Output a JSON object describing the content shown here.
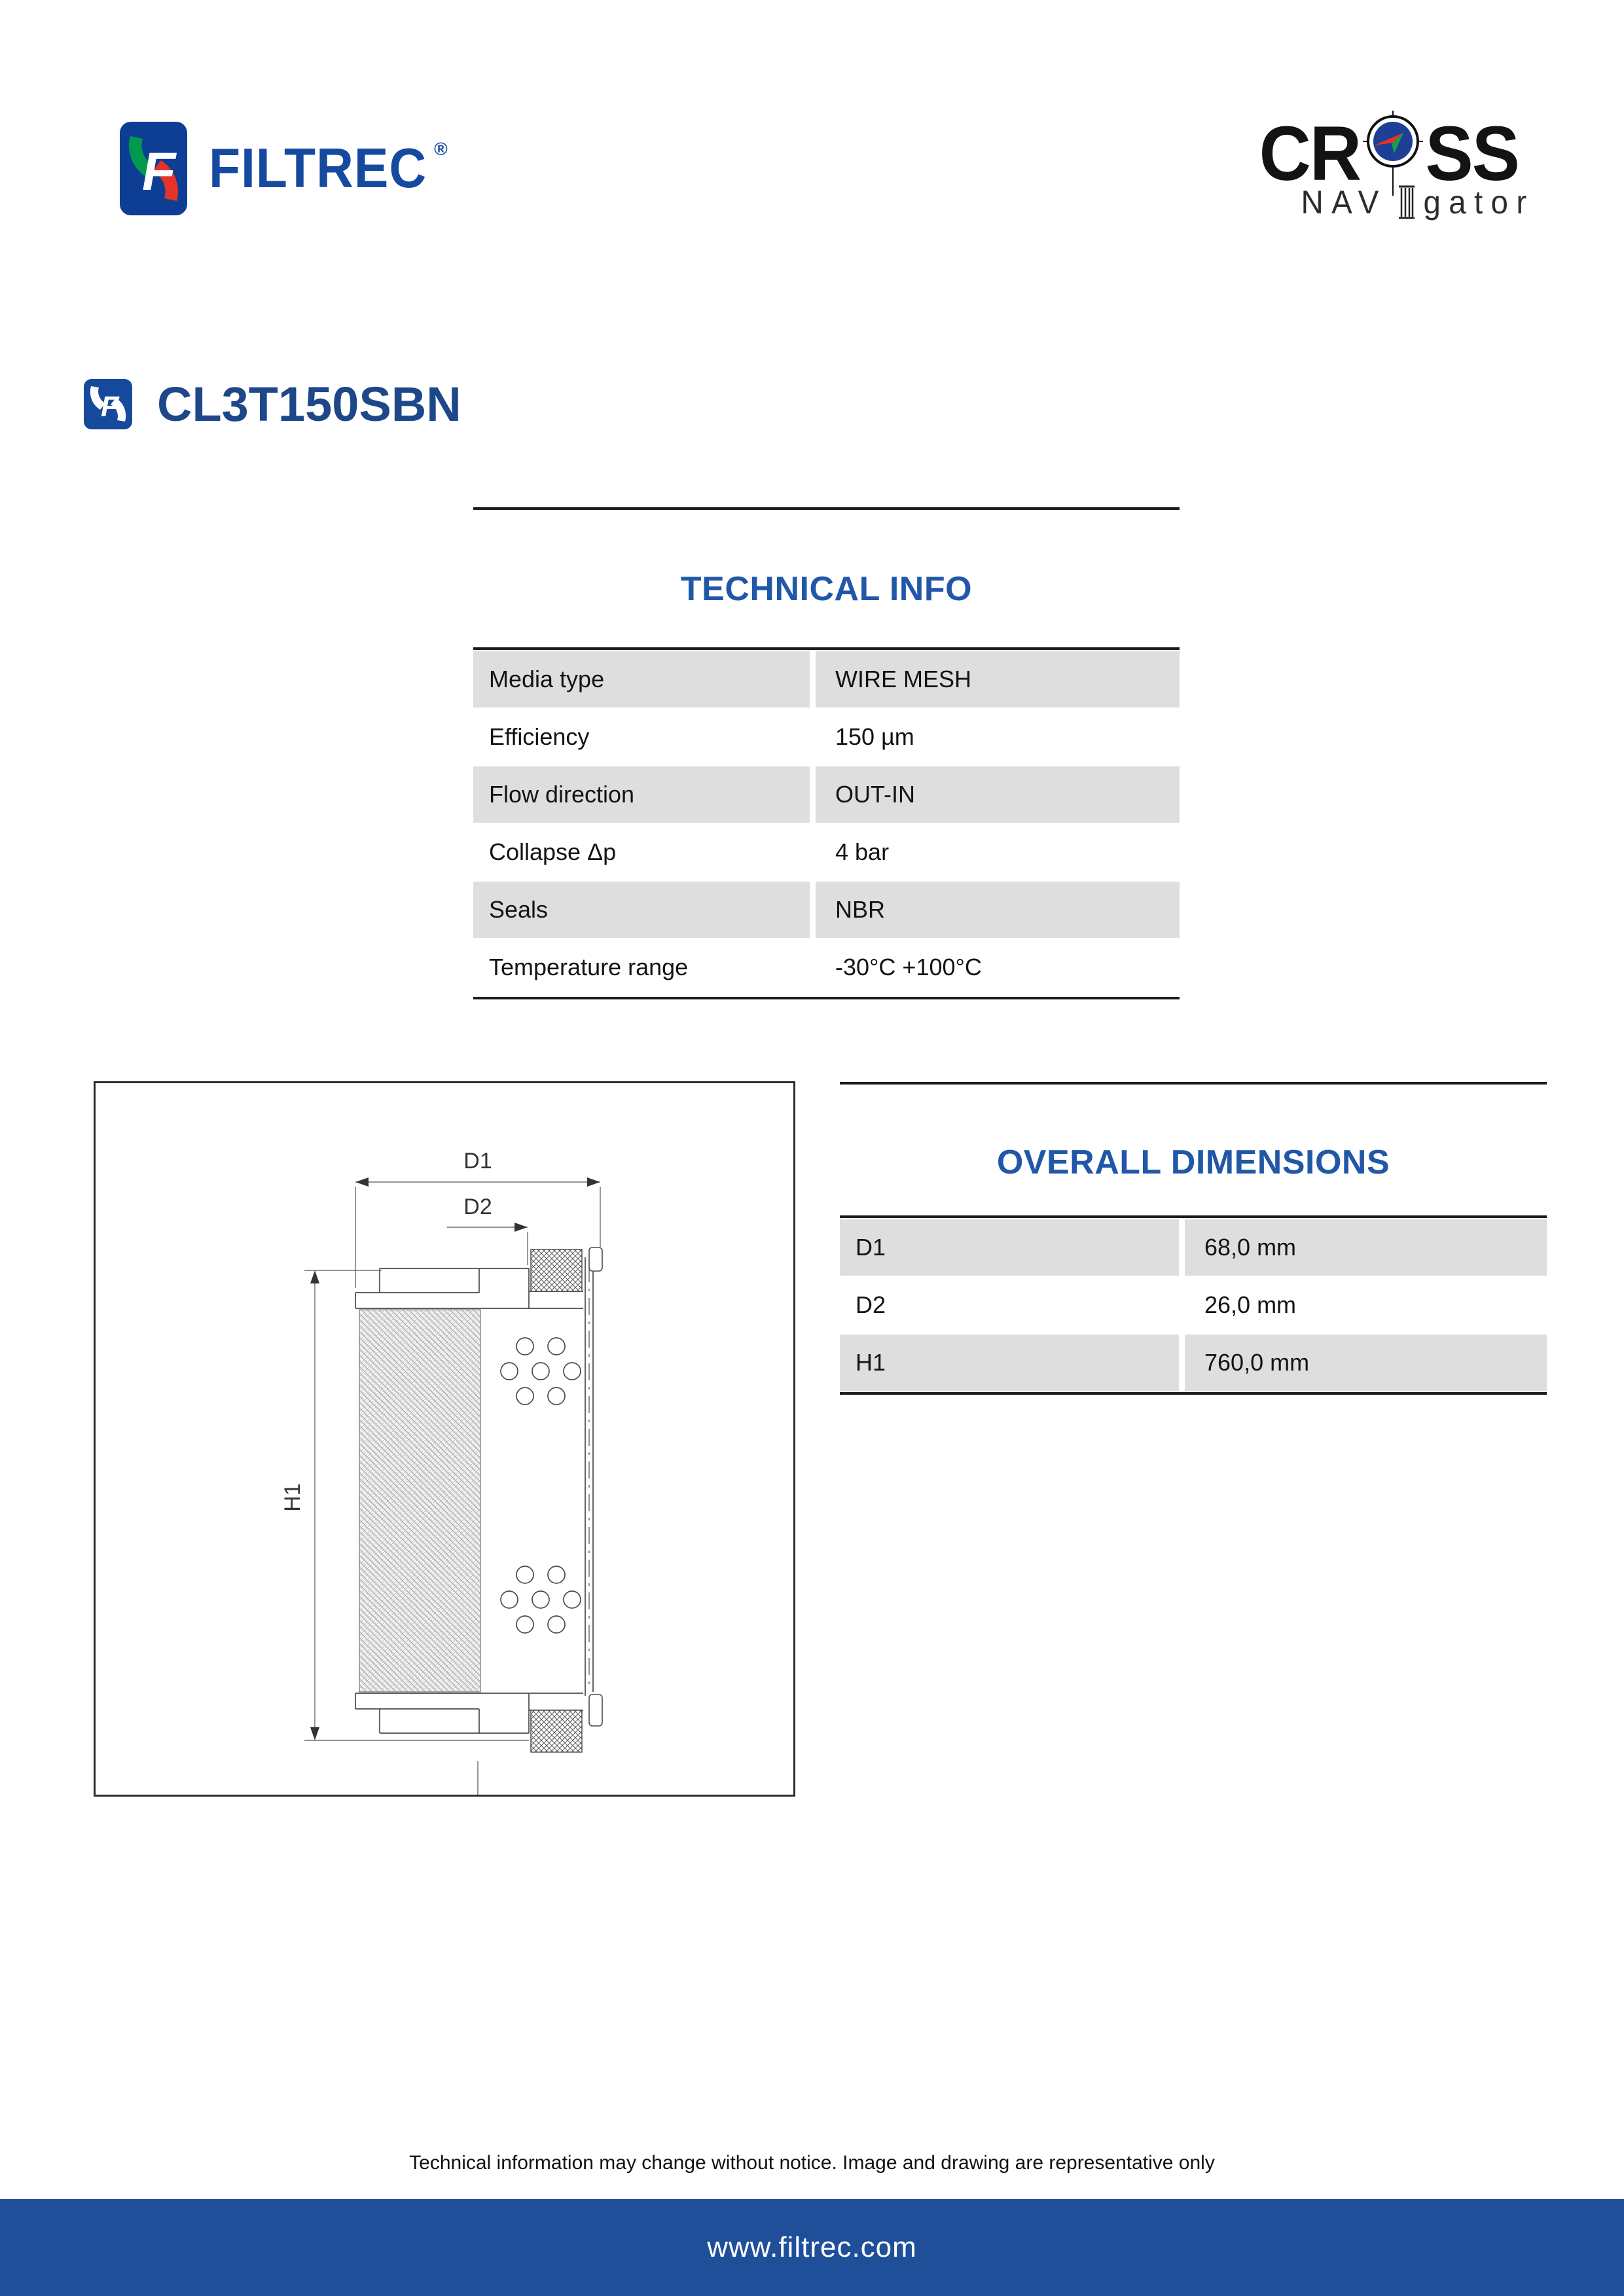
{
  "brand": {
    "filtrec_wordmark": "FILTREC",
    "registered_mark": "®",
    "cross_line1_left": "CR",
    "cross_line1_right": "SS",
    "cross_line2_left": "NAV",
    "cross_line2_right": "gator"
  },
  "product": {
    "code": "CL3T150SBN"
  },
  "technical_info": {
    "title": "TECHNICAL INFO",
    "rows": [
      {
        "label": "Media type",
        "value": "WIRE MESH"
      },
      {
        "label": "Efficiency",
        "value": "150 µm"
      },
      {
        "label": "Flow direction",
        "value": "OUT-IN"
      },
      {
        "label": "Collapse Δp",
        "value": "4 bar"
      },
      {
        "label": "Seals",
        "value": "NBR"
      },
      {
        "label": "Temperature range",
        "value": "-30°C +100°C"
      }
    ]
  },
  "overall_dimensions": {
    "title": "OVERALL DIMENSIONS",
    "rows": [
      {
        "label": "D1",
        "value": "68,0 mm"
      },
      {
        "label": "D2",
        "value": "26,0 mm"
      },
      {
        "label": "H1",
        "value": "760,0 mm"
      }
    ]
  },
  "drawing": {
    "d1": "D1",
    "d2": "D2",
    "h1": "H1"
  },
  "footer": {
    "disclaimer": "Technical information may change without notice. Image and drawing are representative only",
    "website": "www.filtrec.com"
  },
  "colors": {
    "heading_blue": "#2157a8",
    "title_blue": "#1d4788",
    "logo_blue": "#0d3e94",
    "logo_green": "#009a4e",
    "logo_red": "#e5332a",
    "compass_blue": "#1e3f96",
    "footer_bar_blue": "#1f4f99",
    "table_gray": "#dedede"
  }
}
